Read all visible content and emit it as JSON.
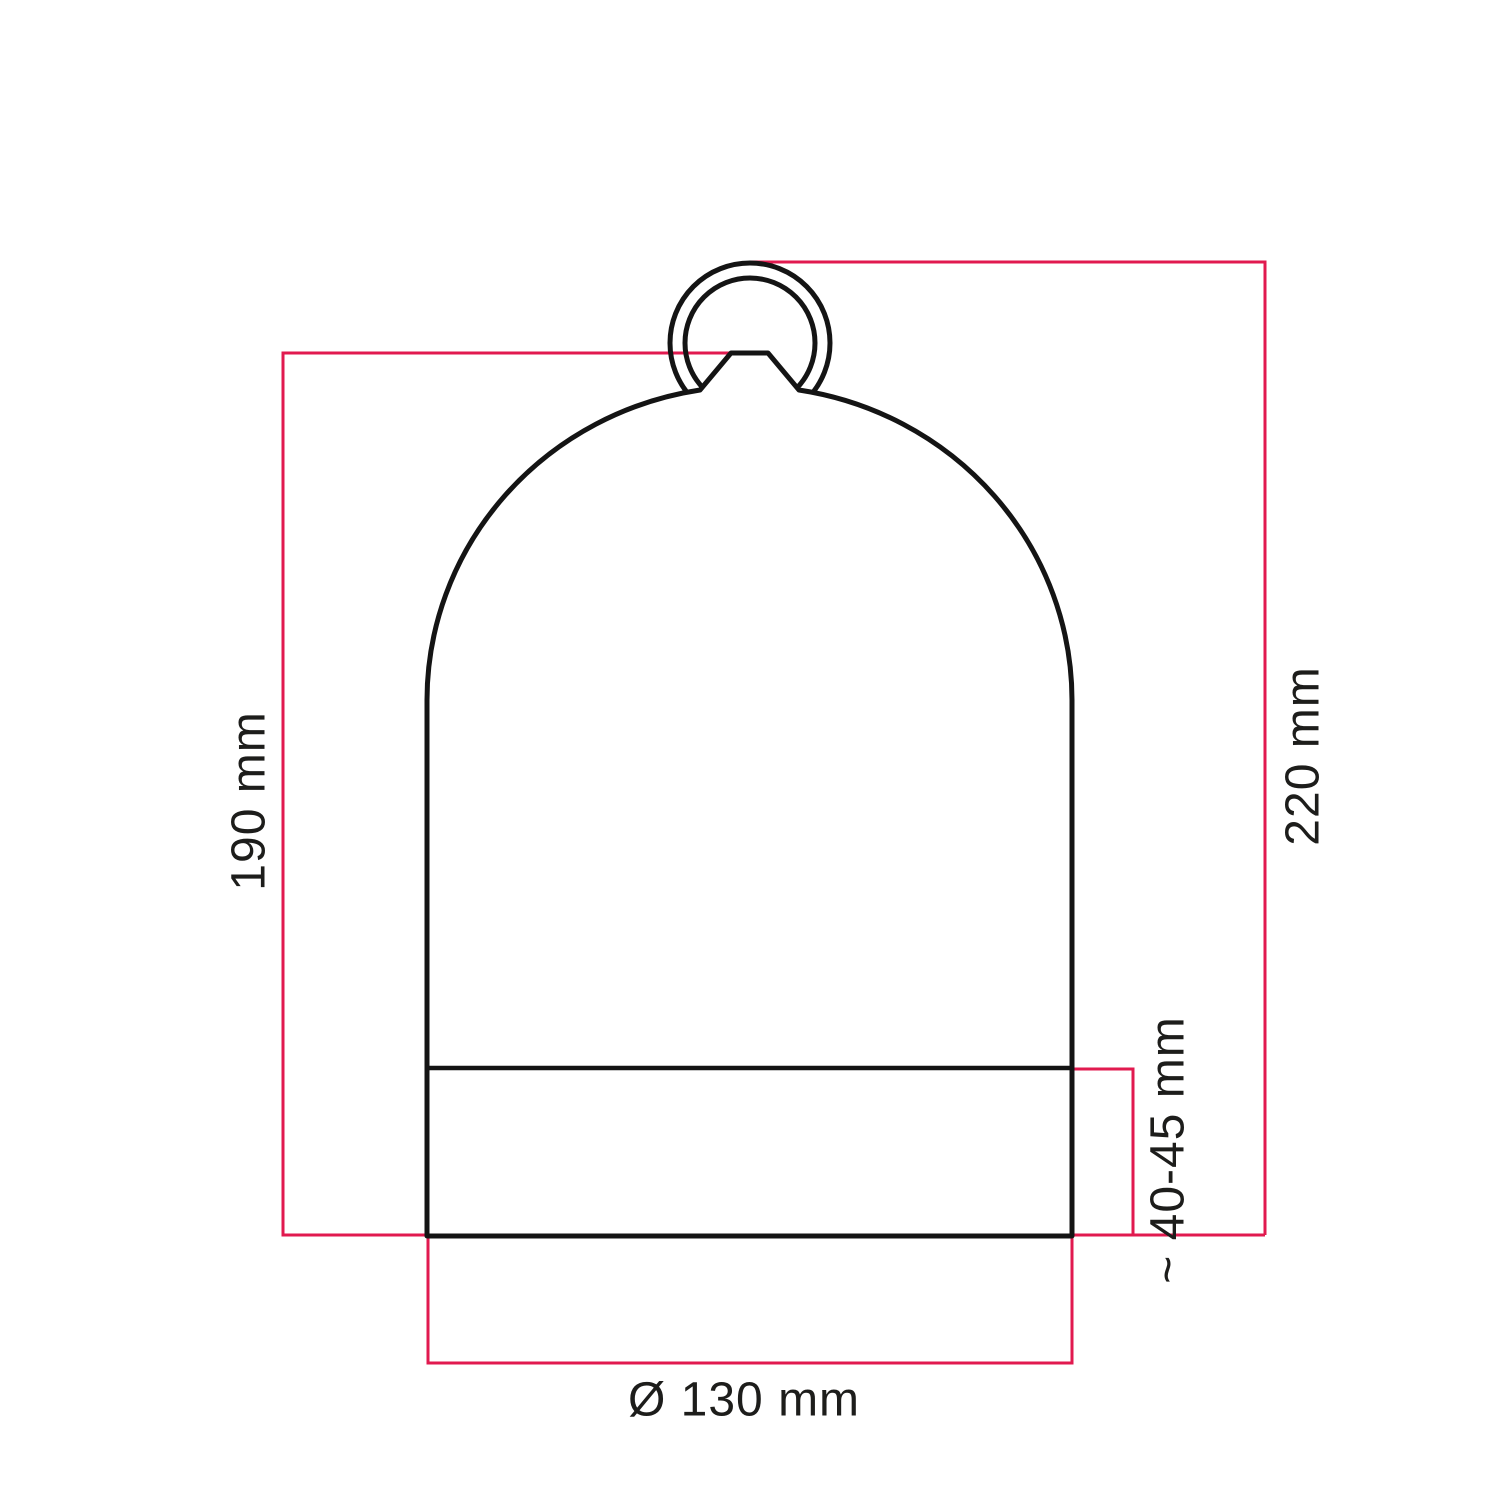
{
  "diagram": {
    "type": "technical-dimension-drawing",
    "subject": "bell-shaped lampshade with hanging ring, dome body and base band",
    "colors": {
      "dimension_line": "#e11a4f",
      "outline": "#141414",
      "text": "#1d1d1b",
      "background": "#ffffff"
    },
    "dimensions": {
      "body_height": "190 mm",
      "total_height": "220 mm",
      "base_band_height": "~ 40-45 mm",
      "diameter": "Ø 130 mm"
    }
  }
}
